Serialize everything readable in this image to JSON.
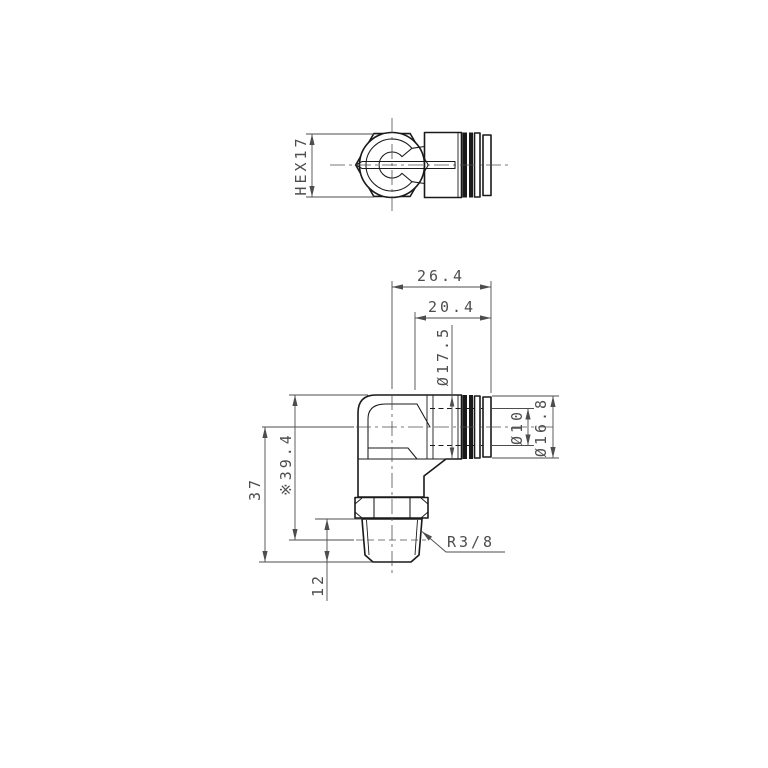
{
  "colors": {
    "line": "#1a1a1a",
    "dim": "#4d4d4d",
    "background": "#ffffff"
  },
  "top_view": {
    "hex_width": "HEX17"
  },
  "front_view": {
    "overall_width": "26.4",
    "body_width": "20.4",
    "body_dia": "Ø17.5",
    "tube_dia": "Ø10",
    "ring_dia": "Ø16.8",
    "ref_height": "※39.4",
    "total_height": "37",
    "thread_length": "12",
    "thread_size": "R3/8"
  }
}
